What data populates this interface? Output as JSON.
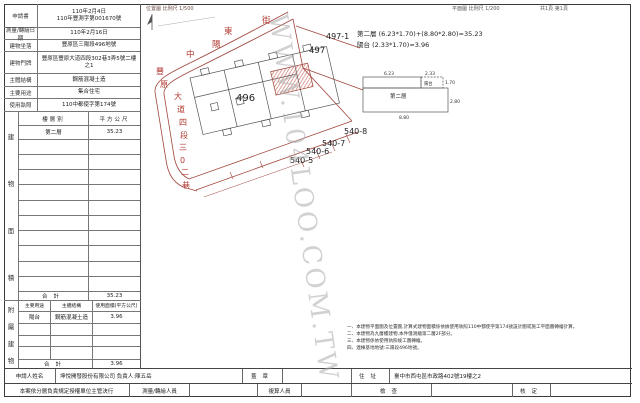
{
  "header": {
    "location_scale": "位置圖 比例尺 1/500",
    "plan_scale": "平面圖 比例尺 1/200",
    "pages": "共1頁 第1頁"
  },
  "watermark": "WWW.104LOO.COM.TW",
  "info_table": {
    "rows": [
      {
        "label": "申請書",
        "value": "110年2月4日\n110年豐測字第001670號"
      },
      {
        "label": "測量/轉繪日期",
        "value": "110年2月16日"
      },
      {
        "label": "建物坐落",
        "value": "豐原區三陽段496地號"
      },
      {
        "label": "建物門牌",
        "value": "豐原區豐原大道四段302巷3弄5號二樓之1"
      },
      {
        "label": "主體結構",
        "value": "鋼筋混凝土造"
      },
      {
        "label": "主要用途",
        "value": "集合住宅"
      },
      {
        "label": "使用執照",
        "value": "110中都使字第174號"
      }
    ]
  },
  "area_table": {
    "side_chars": [
      "建",
      "物",
      "面",
      "積"
    ],
    "header": [
      "樓層別",
      "平方公尺"
    ],
    "rows": [
      {
        "floor": "第二層",
        "area": "35.23"
      }
    ],
    "total_label": "合計",
    "total": "35.23"
  },
  "annex_table": {
    "side_chars": [
      "附",
      "屬",
      "建",
      "物"
    ],
    "header": [
      "主要用途",
      "主體結構",
      "使用面積(平方公尺)"
    ],
    "rows": [
      {
        "use": "陽台",
        "structure": "鋼筋混凝土造",
        "area": "3.96"
      }
    ],
    "total_label": "合計",
    "total": "3.96"
  },
  "map": {
    "street_top_chars": [
      "中",
      "陽",
      "東",
      "街"
    ],
    "street_left_chars": [
      "豐",
      "原",
      "大",
      "道",
      "四",
      "段",
      "三",
      "0",
      "二",
      "巷"
    ],
    "parcels": {
      "p496": "496",
      "p497": "497",
      "p497_1": "497-1",
      "p540_5": "540-5",
      "p540_6": "540-6",
      "p540_7": "540-7",
      "p540_8": "540-8"
    },
    "colors": {
      "line_red": "#a0453c",
      "street_text_red": "#b03a30",
      "hatch_red": "#c2574a"
    }
  },
  "plan": {
    "formula_floor": "第二層 (6.23*1.70)+(8.80*2.80)=35.23",
    "formula_balcony": "陽台 (2.33*1.70)=3.96",
    "floor_label": "第二層",
    "balcony_label": "陽台",
    "dims": {
      "w_strip": "6.23",
      "w_balcony": "2.33",
      "h_strip": "1.70",
      "w_main": "8.80",
      "h_main": "2.80"
    }
  },
  "notes": [
    "一、本建物平面圖及位置圖,計算式建物面積係依據使用執照110中都使字第174號設計圖或施工平面圖轉繪計算。",
    "二、本建物為九層樓建物,本件僅測繪第二層2F部分。",
    "三、本建物係依使用執照竣工圖轉繪。",
    "四、連棟基地地號:三陽段496地號。"
  ],
  "footer": {
    "applicant_label": "申請人姓名",
    "applicant": "坤悅開發股份有限公司 負責人:陳五岳",
    "seal_label": "蓋章",
    "address_label": "住址",
    "address": "臺中市西屯區市政路402號19樓之2",
    "delegation": "本案依分層負責規定授權單位主管決行",
    "surveyor_label": "測量/轉繪人員",
    "checker_label": "複算人員",
    "inspect_label": "檢查",
    "approve_label": "核定"
  }
}
